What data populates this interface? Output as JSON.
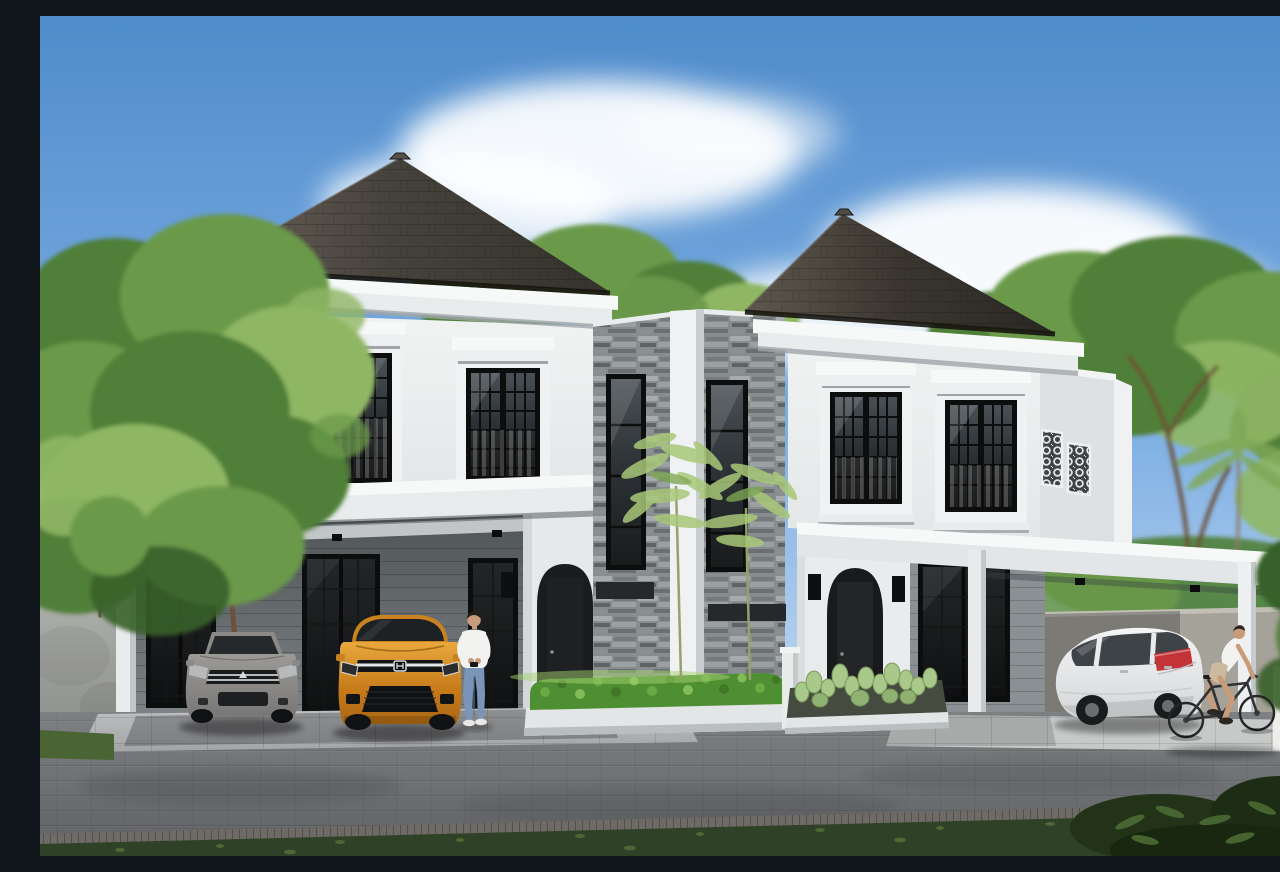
{
  "scene": {
    "type": "architectural-exterior-rendering",
    "subject": "Twin two-story white classic-modern houses with dark shingle hip roofs, a central stone-clad bay, arched entry porches, carports with parked cars, trimmed hedge and cactus bed, paver street, trees and blue sky",
    "time_of_day": "daytime, clear sky with scattered clouds"
  },
  "palette": {
    "sky-top": "#4F8CCB",
    "sky-mid": "#7FB0E4",
    "sky-horizon": "#C9DDF2",
    "cloud": "#FFFFFF",
    "roof-dark": "#35312B",
    "roof-light": "#6A6259",
    "cornice": "#F7F9F9",
    "wall-bright": "#F1F3F3",
    "wall-light": "#E4E7E8",
    "wall-shade": "#C9CED1",
    "wall-shadow": "#9AA0A3",
    "stone": "#878D8F",
    "stone-dark": "#5E6466",
    "frame": "#0C0D0D",
    "glass-dark": "#1A1C1E",
    "hedge": "#4F8F33",
    "hedge-light": "#8CC45E",
    "cactus": "#A9C98B",
    "tree-green": "#6B9A4A",
    "tree-dark": "#4F7F37",
    "tree-light": "#8FB764",
    "tree-deep": "#39602A",
    "trunk": "#6E513A",
    "concrete": "#9C9E99",
    "road": "#747679",
    "apron": "#BFC1C2",
    "curb": "#E3E6E6",
    "grass-dark": "#2F4126",
    "grass-light": "#4A6533",
    "car-silver": "#908E8B",
    "car-orange": "#D78E2B",
    "car-white": "#EDEEEF",
    "taillight": "#C23438",
    "skin": "#C89B7B",
    "shirt": "#F2F2F0",
    "denim": "#7B95B8",
    "shorts": "#CBB9A0"
  },
  "objects": {
    "buildings": [
      "left-house",
      "central-stone-bay",
      "right-house"
    ],
    "building_features": [
      "hip-shingle-roof",
      "classical-cornice",
      "pediment-windows",
      "ornamental-lattice-parapet-panels",
      "arched-entry-door",
      "wall-sconces",
      "flat-carport-canopy",
      "stone-cladding"
    ],
    "vehicles": [
      {
        "name": "silver-sedan",
        "location": "left carport",
        "facing": "front"
      },
      {
        "name": "orange-hatchback",
        "location": "left carport",
        "facing": "front"
      },
      {
        "name": "white-hatchback",
        "location": "right carport",
        "facing": "rear-three-quarter"
      }
    ],
    "people": [
      {
        "name": "man-standing-with-phone",
        "location": "beside orange hatchback"
      },
      {
        "name": "cyclist",
        "location": "street, right side, riding right"
      }
    ],
    "vegetation": [
      "large-tree-left",
      "background-trees",
      "palm-fronds-right",
      "slender-trees-center",
      "trimmed-hedge",
      "cactus-bed",
      "grass-strips"
    ],
    "hardscape": [
      "paver-street",
      "tiled-driveway-aprons",
      "concrete-boundary-walls",
      "white-planter-curbs",
      "white-bollard"
    ]
  }
}
